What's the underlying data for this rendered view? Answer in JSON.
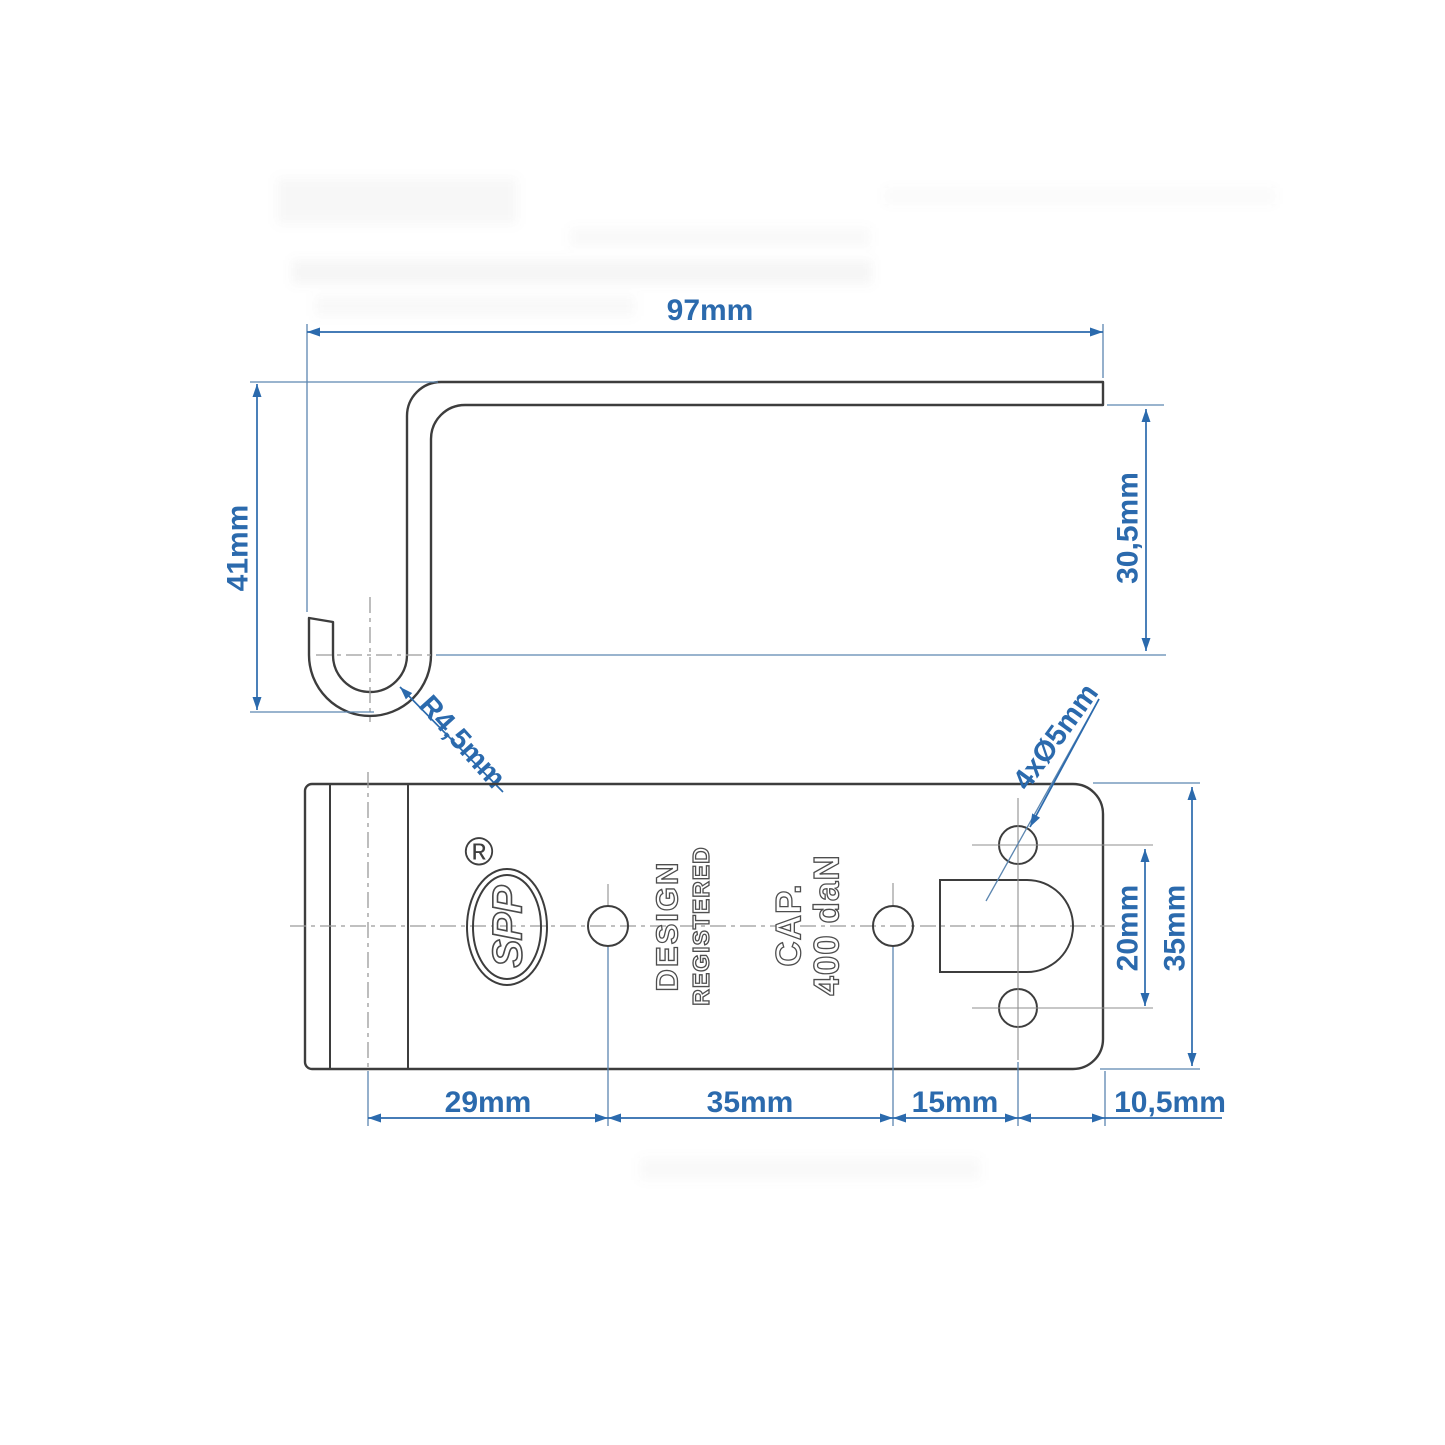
{
  "side_view": {
    "width_label": "97mm",
    "height_label": "41mm",
    "flange_label": "30,5mm",
    "radius_label": "R4,5mm"
  },
  "plan_view": {
    "holes_label": "4xØ5mm",
    "hole_spacing_label": "20mm",
    "plate_width_label": "35mm",
    "chain": {
      "seg1": "29mm",
      "seg2": "35mm",
      "seg3": "15mm",
      "seg4": "10,5mm"
    },
    "logo": {
      "text": "SPP",
      "registered": "®"
    },
    "stamps": {
      "line1": "DESIGN",
      "line2": "REGISTERED",
      "cap": "CAP.",
      "load": "400 daN"
    }
  },
  "colors": {
    "dimension_blue": "#2b6aad",
    "outline_gray": "#3d3d3d",
    "centerline_gray": "#9a9a9a",
    "background": "#ffffff"
  }
}
